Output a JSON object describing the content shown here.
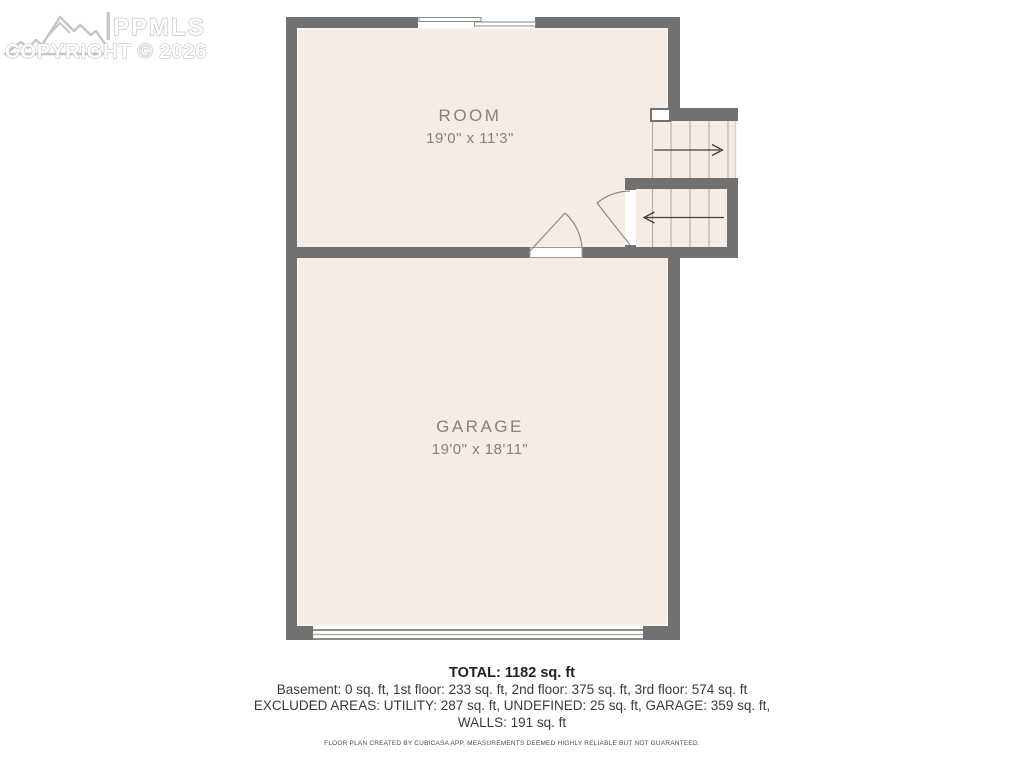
{
  "watermark": {
    "brand": "PPMLS",
    "copyright": "COPYRIGHT © 2026"
  },
  "floorplan": {
    "rooms": [
      {
        "name": "ROOM",
        "dimensions": "19'0\" x 11'3\""
      },
      {
        "name": "GARAGE",
        "dimensions": "19'0\" x 18'11\""
      }
    ],
    "features": [
      "staircase-up-arrow",
      "staircase-down-arrow",
      "swing-door-room",
      "swing-door-stairs",
      "sliding-door-top-wall",
      "garage-door-bottom-wall"
    ],
    "colors": {
      "wall": "#73716f",
      "floor": "#f5ece5",
      "label_text": "#8a8177",
      "tread_line": "#b5afa8",
      "arrow": "#3f3f3f",
      "door_stroke": "#8e8a84",
      "watermark_outline": "#c5c5c5"
    }
  },
  "summary": {
    "total": "TOTAL: 1182 sq. ft",
    "floor_breakdown": "Basement: 0 sq. ft, 1st floor: 233 sq. ft, 2nd floor: 375 sq. ft, 3rd floor: 574 sq. ft",
    "excluded_areas": "EXCLUDED AREAS: UTILITY: 287 sq. ft, UNDEFINED: 25 sq. ft, GARAGE: 359 sq. ft,",
    "walls": "WALLS: 191 sq. ft",
    "disclaimer": "FLOOR PLAN CREATED BY CUBICASA APP. MEASUREMENTS DEEMED HIGHLY RELIABLE BUT NOT GUARANTEED."
  }
}
